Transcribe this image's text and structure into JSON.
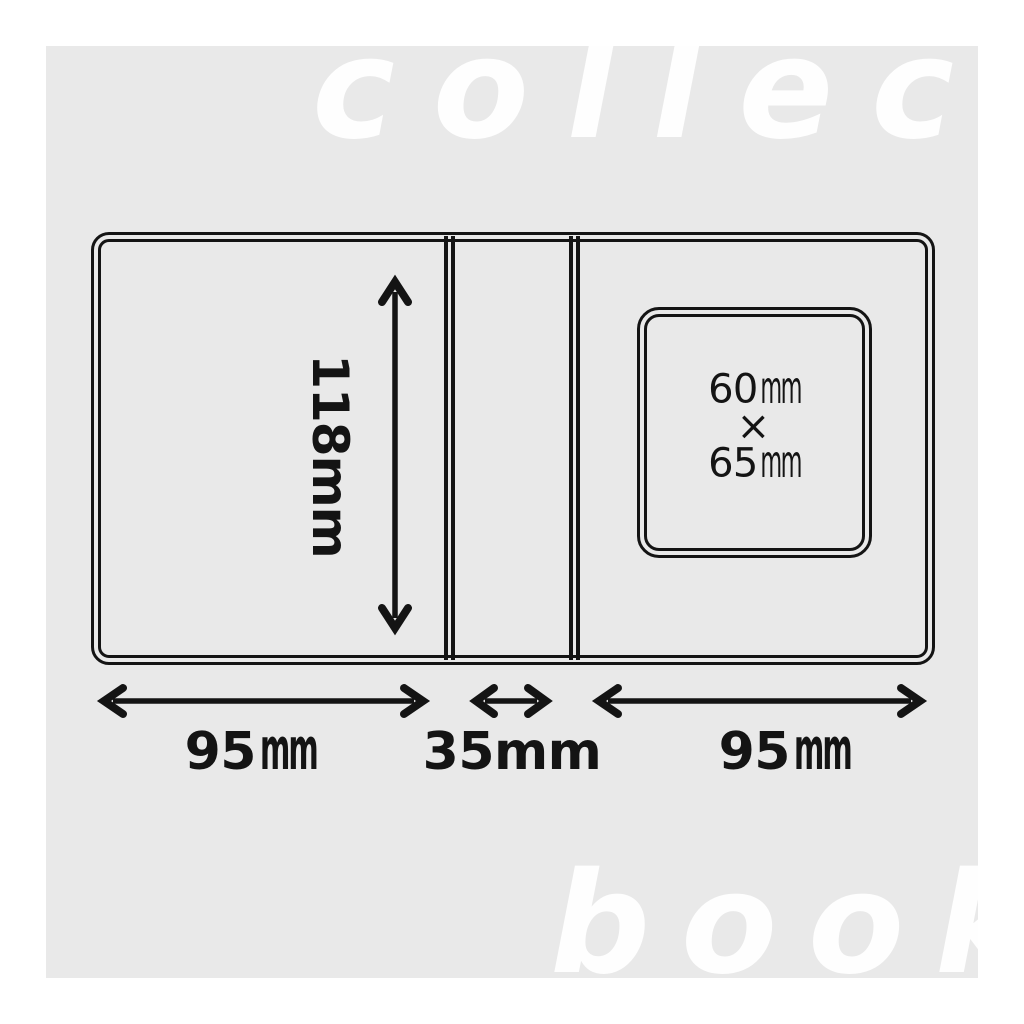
{
  "watermark": {
    "top": "collect",
    "bottom": "book"
  },
  "diagram": {
    "product": "collect book cover unfolded dimension drawing",
    "height_dimension": {
      "value": "118",
      "unit": "mm"
    },
    "left_cover_width": {
      "value": "95",
      "unit": "mm"
    },
    "spine_width": {
      "value": "35",
      "unit": "mm"
    },
    "right_cover_width": {
      "value": "95",
      "unit": "mm"
    },
    "window_label": {
      "width_value": "60",
      "width_unit": "mm",
      "multiply_sign": "×",
      "height_value": "65",
      "height_unit": "mm"
    }
  },
  "colors": {
    "stage_background": "#e9e9e9",
    "line": "#141414",
    "watermark_text": "#fefefe",
    "page_background": "#ffffff"
  }
}
